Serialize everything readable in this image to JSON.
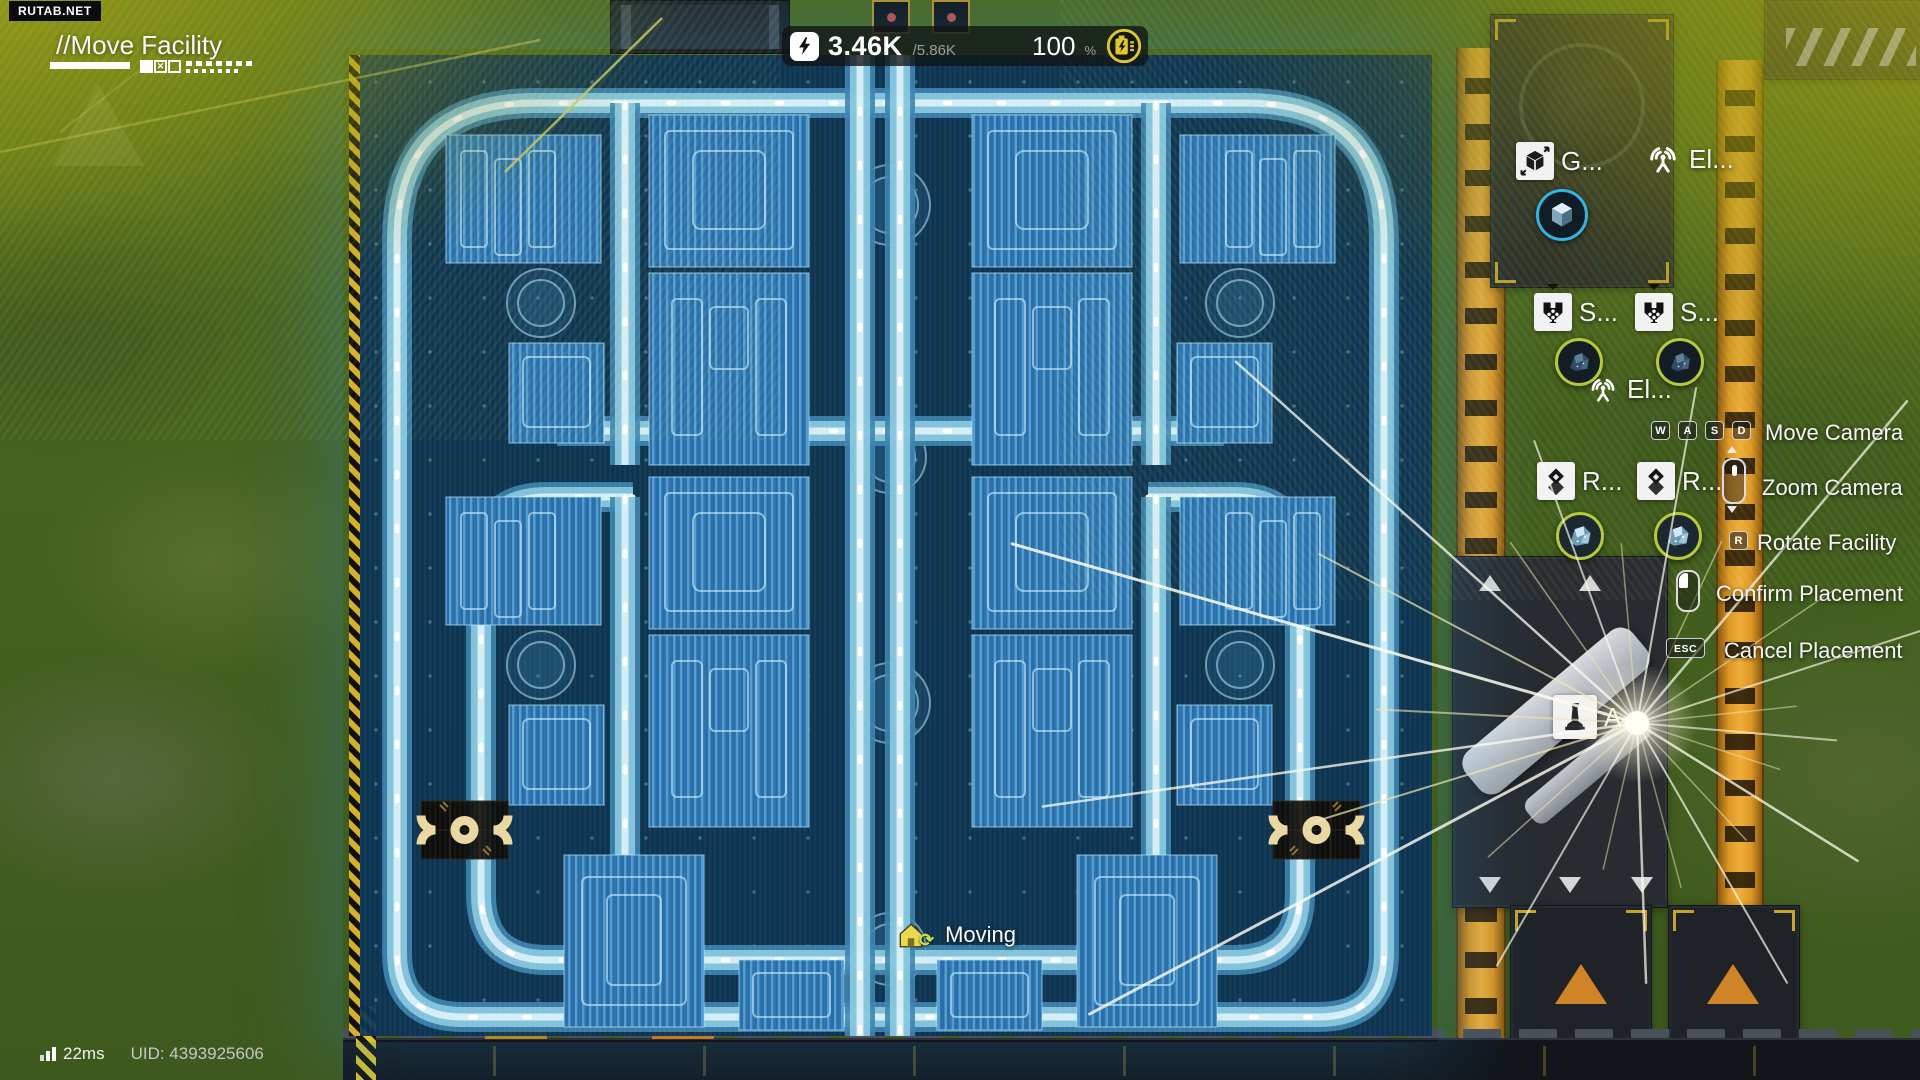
{
  "watermark": "RUTAB.NET",
  "title": {
    "heading": "//Move Facility"
  },
  "power_bar": {
    "current": "3.46K",
    "max": "/5.86K",
    "percent": "100",
    "unit": "%"
  },
  "labels": {
    "grabber": "G...",
    "electric_top": "El...",
    "sorter_1": "S...",
    "sorter_2": "S...",
    "electric_mid": "El...",
    "refinery_1": "R...",
    "refinery_2": "R...",
    "tower": "A..."
  },
  "controls": {
    "move_camera": {
      "keys": [
        "W",
        "A",
        "S",
        "D"
      ],
      "label": "Move Camera"
    },
    "zoom_camera": {
      "label": "Zoom Camera"
    },
    "rotate_facility": {
      "key": "R",
      "label": "Rotate Facility"
    },
    "confirm_placement": {
      "label": "Confirm Placement"
    },
    "cancel_placement": {
      "key": "ESC",
      "label": "Cancel Placement"
    }
  },
  "toast": {
    "label": "Moving"
  },
  "footer": {
    "latency": "22ms",
    "uid": "UID: 4393925606"
  },
  "icons": {
    "power": "lightning-bolt",
    "battery": "battery-charge",
    "ping": "signal-bars",
    "moving": "house-refresh"
  },
  "colors": {
    "hologram_block": "#2f7fc0",
    "hologram_base": "#0a3254",
    "conveyor_cyan": "#8fcfe4",
    "conveyor_orange": "#dd9826",
    "accent_yellow": "#ddc832",
    "ring_cyan": "#35b3e2",
    "ring_lime": "#b6c93c"
  }
}
